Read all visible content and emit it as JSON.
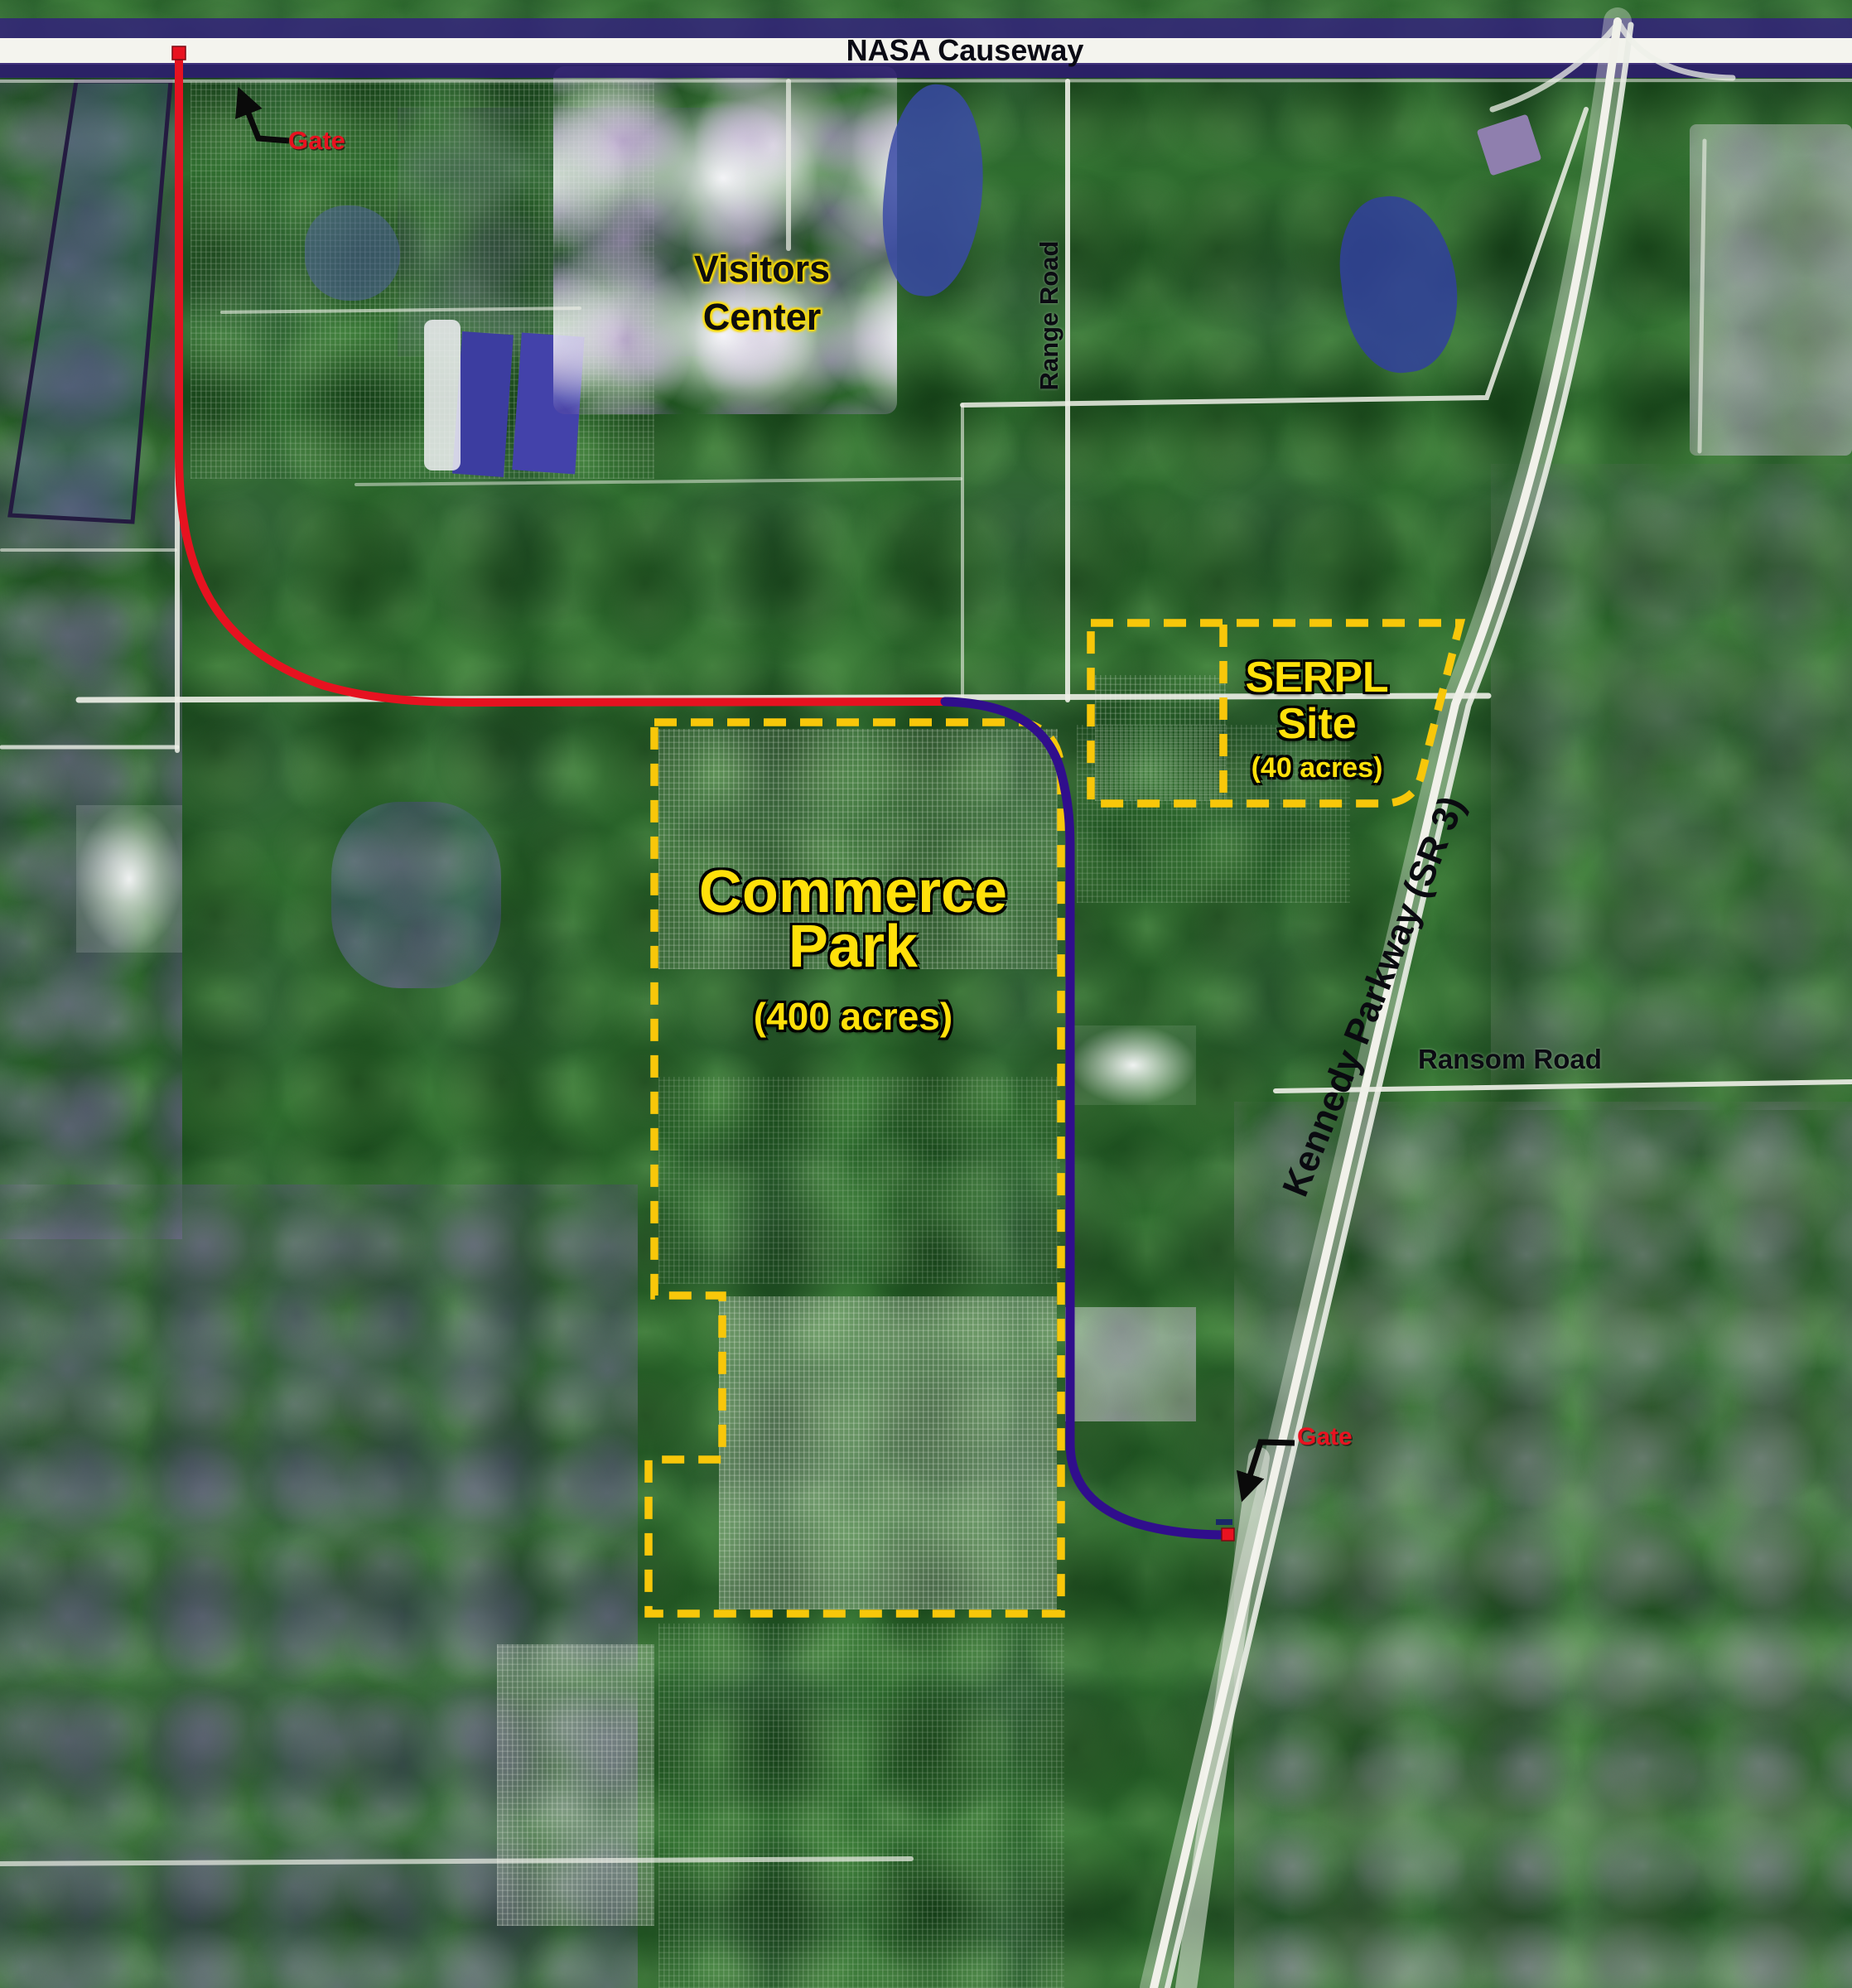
{
  "map": {
    "roads": {
      "nasa_causeway": "NASA Causeway",
      "range_road": "Range Road",
      "kennedy_parkway": "Kennedy Parkway (SR 3)",
      "ransom_road": "Ransom Road"
    },
    "sites": {
      "visitors_center": {
        "line1": "Visitors",
        "line2": "Center"
      },
      "serpl": {
        "line1": "SERPL",
        "line2": "Site",
        "acreage": "(40 acres)"
      },
      "commerce_park": {
        "line1": "Commerce",
        "line2": "Park",
        "acreage": "(400 acres)"
      }
    },
    "gates": {
      "north": "Gate",
      "south": "Gate"
    },
    "colors": {
      "route_red": "#e61220",
      "route_purple": "#300e8c",
      "boundary_yellow": "#f8c70a",
      "site_label_yellow": "#ffe00a",
      "gate_label_red": "#e81220",
      "road_label_black": "#0b0b12",
      "causeway_indigo": "#2c1d6e",
      "road_white": "#f2f2ec"
    }
  }
}
